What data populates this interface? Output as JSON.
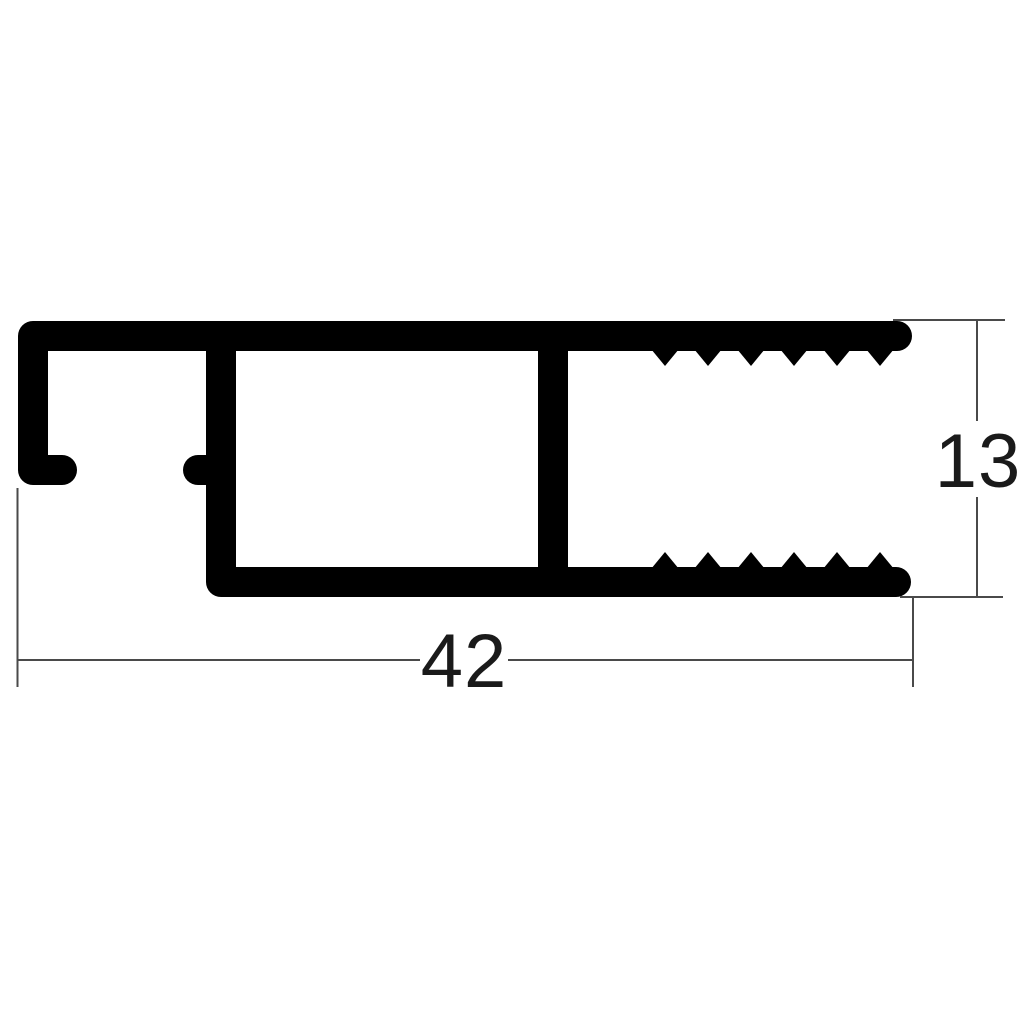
{
  "drawing": {
    "kind": "profile-cross-section-technical-drawing",
    "dimensions": {
      "width": {
        "label": "42"
      },
      "height": {
        "label": "13"
      }
    },
    "colors": {
      "profile": "#000000",
      "dimension_lines": "#4a4a4a",
      "text": "#1a1a1a",
      "background": "#ffffff"
    }
  }
}
